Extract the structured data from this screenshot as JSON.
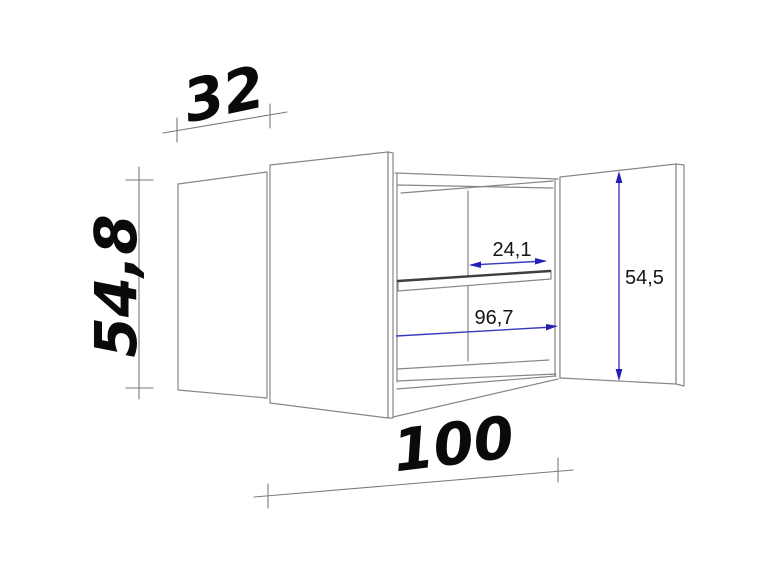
{
  "dimensions": {
    "depth": {
      "label": "32"
    },
    "height": {
      "label": "54,8"
    },
    "width": {
      "label": "100"
    },
    "interior_clear_width_upper": {
      "label": "24,1"
    },
    "interior_width": {
      "label": "96,7"
    },
    "door_height": {
      "label": "54,5"
    }
  },
  "colors": {
    "line": "#878787",
    "dim_line": "#7a7a7a",
    "shelf_edge": "#3f3f3f",
    "blue": "#3a3ac0",
    "blue_dark": "#2222b2",
    "text_black": "#0a0a0a",
    "background": "#ffffff"
  }
}
